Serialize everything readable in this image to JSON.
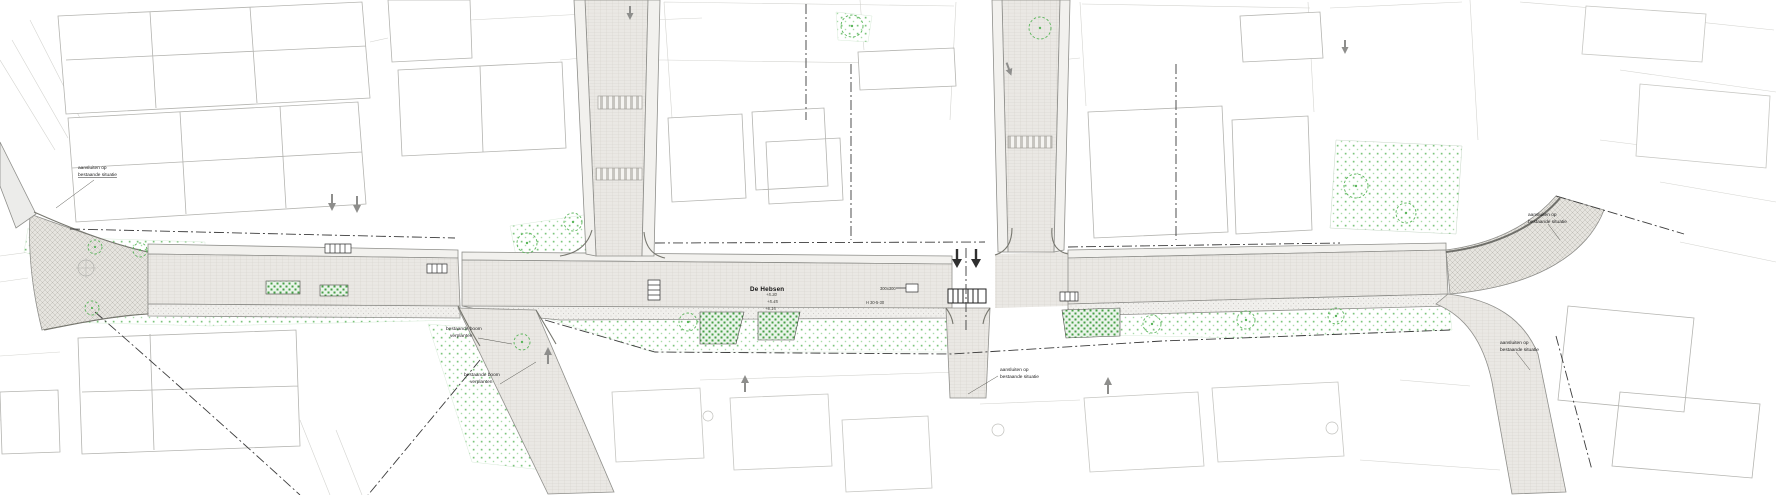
{
  "street_name": "De Hebsen",
  "annotations": [
    {
      "line1": "aansluiten op",
      "line2": "bestaande situatie"
    },
    {
      "line1": "bestaande boom",
      "line2": "verplanten"
    },
    {
      "line1": "bestaande boom",
      "line2": "verplanten"
    },
    {
      "line1": "aansluiten op",
      "line2": "bestaande situatie"
    },
    {
      "line1": "aansluiten op",
      "line2": "bestaande situatie"
    },
    {
      "line1": "aansluiten op",
      "line2": "bestaande situatie"
    }
  ],
  "levels": [
    "+5.30",
    "+5.45",
    "+6.15"
  ],
  "specs": {
    "tile": "300x300",
    "profile": "H 30-5-30"
  },
  "colors": {
    "vegetation": "#7cc57c",
    "planting_bed": "#45a045",
    "road_paving": "#eae8e4",
    "project_boundary": "#3c3c3c",
    "building_outline": "#b4b4b0"
  }
}
